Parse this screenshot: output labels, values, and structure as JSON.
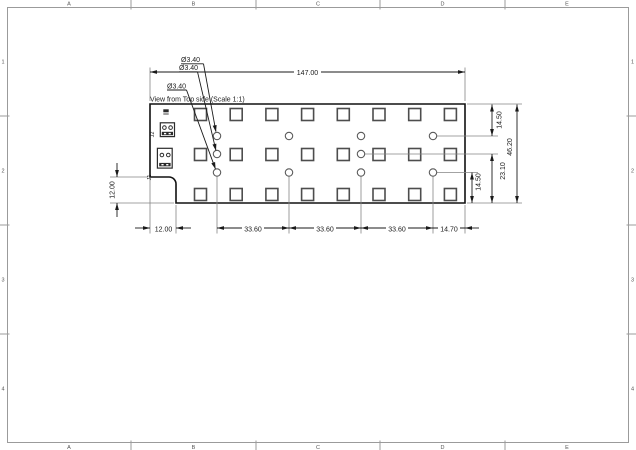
{
  "sheet": {
    "columns": [
      "A",
      "B",
      "C",
      "D",
      "E"
    ],
    "rows": [
      "1",
      "2",
      "3",
      "4"
    ]
  },
  "view": {
    "title": "View from Top side (Scale 1:1)"
  },
  "dimensions": {
    "overall_width": "147.00",
    "overall_height": "46.20",
    "hole_row_top_offset": "14.50",
    "hole_row_bottom_offset": "14.50",
    "mid_row_offset": "23.10",
    "hole_pitch_1": "33.60",
    "hole_pitch_2": "33.60",
    "hole_pitch_3": "33.60",
    "hole_right_offset": "14.70",
    "notch_width": "12.00",
    "notch_height": "12.00",
    "hole_diameter_1": "Ø3.40",
    "hole_diameter_2": "Ø3.40",
    "hole_diameter_3": "Ø3.40"
  },
  "components": {
    "upper_ref": "J2",
    "lower_ref": "J1"
  },
  "colors": {
    "line": "#1a1a1a",
    "thin_line": "#848484",
    "frame": "#9b9b9b",
    "pad_stroke": "#4d4d4d"
  }
}
